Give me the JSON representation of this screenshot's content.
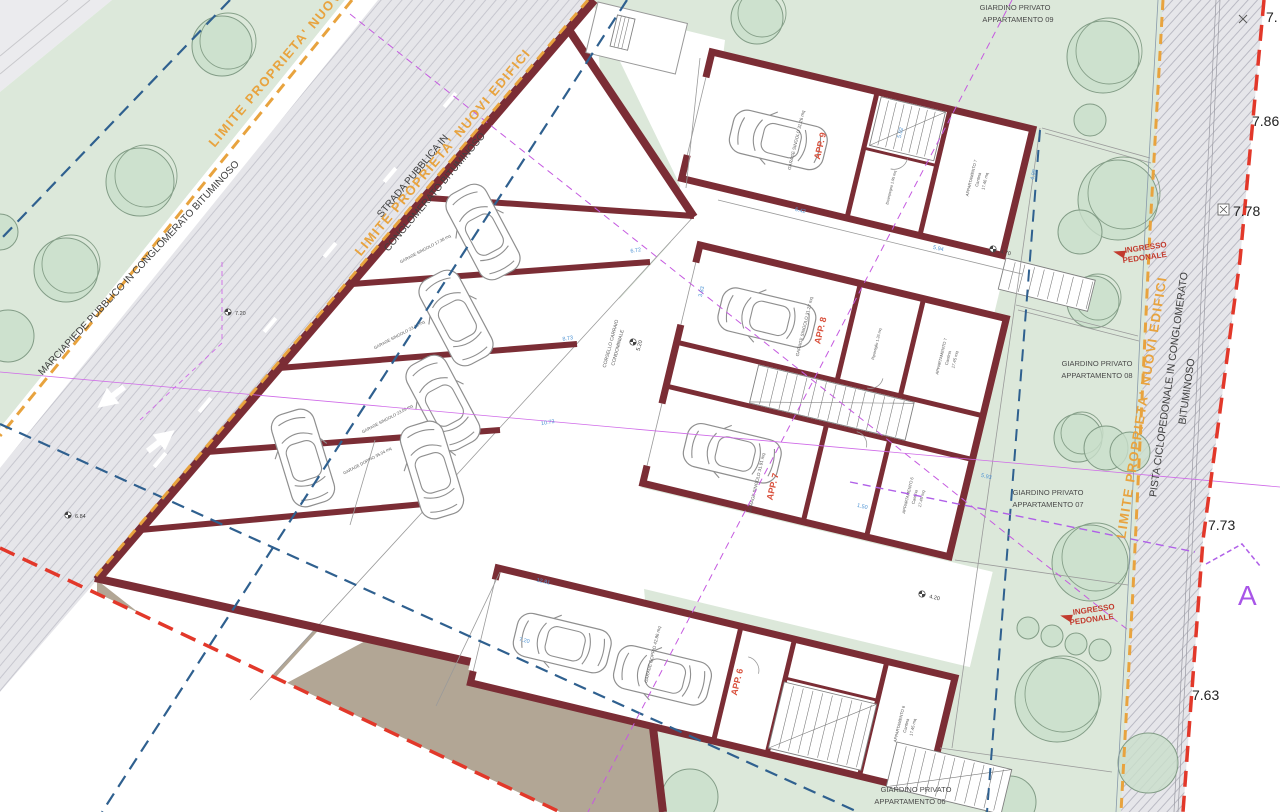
{
  "plan": {
    "boundary_labels": {
      "tl": "LIMITE PROPRIETA' NUOVI",
      "street": "LIMITE PROPRIETA' NUOVI EDIFICI",
      "right": "LIMITE PROPRIETA' NUOVI EDIFICI"
    },
    "road_labels": {
      "strada1": "STRADA PUBBLICA IN",
      "strada2": "CONGLOMERATO BITUMINOSO",
      "marciapiede": "MARCIAPIEDE PUBBLICO IN CONGLOMERATO BITUMINOSO",
      "pista1": "PISTA CICLOPEDONALE IN CONGLOMERATO",
      "pista2": "BITUMINOSO",
      "corsello1": "CORSELLO CARRAIO",
      "corsello2": "CONDOMINIALE"
    },
    "gardens": [
      {
        "l1": "GIARDINO PRIVATO",
        "l2": "APPARTAMENTO 09"
      },
      {
        "l1": "GIARDINO PRIVATO",
        "l2": "APPARTAMENTO 08"
      },
      {
        "l1": "GIARDINO PRIVATO",
        "l2": "APPARTAMENTO 07"
      },
      {
        "l1": "GIARDINO PRIVATO",
        "l2": "APPARTAMENTO 06"
      }
    ],
    "entrance": {
      "l1": "INGRESSO",
      "l2": "PEDONALE"
    },
    "apartments": [
      "APP. 9",
      "APP. 8",
      "APP. 7",
      "APP. 6"
    ],
    "garages": {
      "w1": "GARAGE SINGOLO 17.38 mq",
      "w2": "GARAGE SINGOLO 23.48 mq",
      "w3": "GARAGE SINGOLO 23.09 mq",
      "w4": "GARAGE DOPPIO 35.04 mq",
      "b1": "GARAGE SINGOLO 31.26 mq",
      "b2": "GARAGE SINGOLO 31.27 mq",
      "b3": "GARAGE SINGOLO 31.91 mq",
      "b4": "GARAGE DOPPIO 42.86 mq"
    },
    "rooms": {
      "cantina_a": [
        "APPARTAMENTO 7",
        "Cantina",
        "17.46 mq"
      ],
      "cantina_b": [
        "APPARTAMENTO 7",
        "Cantina",
        "17.45 mq"
      ],
      "cantina_c": [
        "APPARTAMENTO 6",
        "Cantina",
        "17.45 mq"
      ],
      "cantina_d": [
        "APPARTAMENTO 6",
        "Cantina",
        "17.45 mq"
      ],
      "small_a": "Disimpegno 1.95 mq",
      "small_b": "Ripostiglio 1.26 mq"
    },
    "elevations": {
      "edge": [
        "7.",
        "7.86",
        "7.78",
        "7.73",
        "7.63"
      ],
      "spot": [
        "5.20",
        "7.20",
        "6.84",
        "4.20",
        "4.70"
      ]
    },
    "dims": [
      "6.72",
      "8.73",
      "10.73",
      "12.81",
      "6.42",
      "5.94",
      "5.93",
      "5.02",
      "1.50",
      "4.98",
      "3.83",
      "7.20"
    ],
    "section_marker": "A",
    "colors": {
      "wall": "#7b2d35",
      "boundary_orange": "#e8a33e",
      "boundary_red": "#e2382a",
      "sewer_blue": "#2f608f",
      "section_purple": "#b060e8",
      "green": "#dce8da",
      "road": "#e6e6ea",
      "tan": "#c7bdae",
      "brown": "#b2a695",
      "dim_blue": "#4f94d4",
      "label_red": "#d9503c"
    }
  }
}
